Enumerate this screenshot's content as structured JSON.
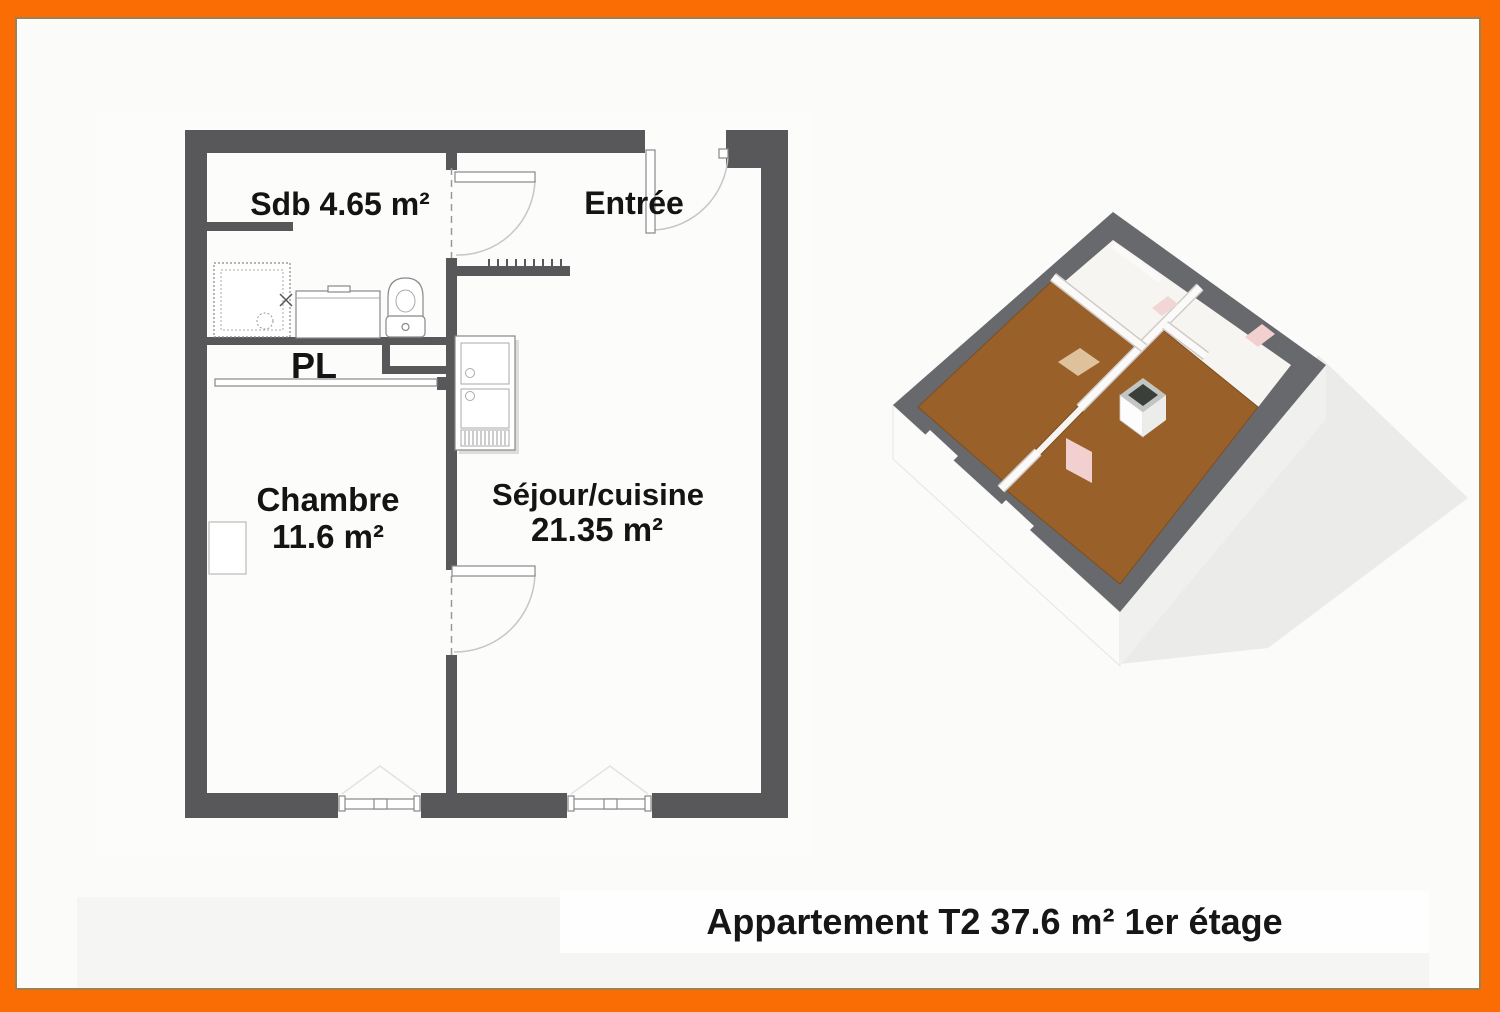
{
  "document": {
    "caption": "Appartement T2 37.6 m² 1er étage"
  },
  "floor_plan_2d": {
    "rooms": {
      "sdb": {
        "label": "Sdb 4.65 m²"
      },
      "entree": {
        "label": "Entrée"
      },
      "pl": {
        "label": "PL"
      },
      "chambre": {
        "label": "Chambre",
        "area": "11.6 m²"
      },
      "sejour": {
        "label": "Séjour/cuisine",
        "area": "21.35 m²"
      }
    },
    "fixtures": [
      "shower",
      "washbasin",
      "toilet",
      "fridge",
      "coat-hooks",
      "radiator",
      "sliding-door",
      "window",
      "door-swing"
    ]
  },
  "view_3d": {
    "name": "apartment-3d-view"
  },
  "colors": {
    "frame_orange": "#FA6D05",
    "frame_inner_line": "#9F8050",
    "wall_gray": "#58585A",
    "wall_top_3d": "#67696D",
    "floor_wood": "#9A6029",
    "door_pink": "#F2D0D0",
    "cabinet_tan": "#DDC29C",
    "text_black": "#141414"
  }
}
